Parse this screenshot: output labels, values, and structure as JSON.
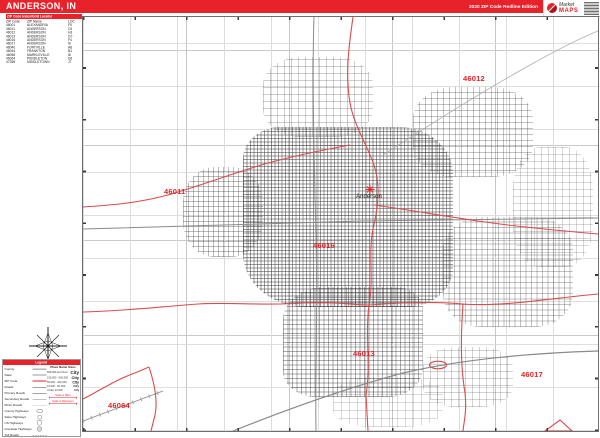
{
  "colors": {
    "accent_red": "#e8222a",
    "boundary_red": "#d94c4c"
  },
  "title_bar": {
    "title": "ANDERSON, IN",
    "edition": "2020 ZIP Code Redline Edition"
  },
  "logo": {
    "name_top": "Market",
    "name_bottom": "MAPS"
  },
  "zip_table": {
    "header": "ZIP Code Index/Grid Locator",
    "columns": [
      "ZIP Code",
      "ZIP Name",
      "LOC"
    ],
    "rows": [
      {
        "zip": "46001",
        "name": "ALEXANDRIA",
        "loc": "F5"
      },
      {
        "zip": "46011",
        "name": "ANDERSON",
        "loc": "C5"
      },
      {
        "zip": "46012",
        "name": "ANDERSON",
        "loc": "H3"
      },
      {
        "zip": "46013",
        "name": "ANDERSON",
        "loc": "G7"
      },
      {
        "zip": "46016",
        "name": "ANDERSON",
        "loc": "F4"
      },
      {
        "zip": "46017",
        "name": "ANDERSON",
        "loc": "I6"
      },
      {
        "zip": "46040",
        "name": "FORTVILLE",
        "loc": "A8"
      },
      {
        "zip": "46044",
        "name": "FRANKTON",
        "loc": "B1"
      },
      {
        "zip": "46056",
        "name": "MARKLEVILLE",
        "loc": "I8"
      },
      {
        "zip": "46064",
        "name": "PENDLETON",
        "loc": "D6"
      },
      {
        "zip": "47356",
        "name": "MIDDLETOWN",
        "loc": "J7"
      }
    ]
  },
  "map": {
    "city_label": "Anderson",
    "zip_labels": [
      {
        "code": "46012",
        "x": 380,
        "y": 57
      },
      {
        "code": "46011",
        "x": 81,
        "y": 170
      },
      {
        "code": "46016",
        "x": 230,
        "y": 224
      },
      {
        "code": "46013",
        "x": 270,
        "y": 332
      },
      {
        "code": "46017",
        "x": 438,
        "y": 353
      },
      {
        "code": "46064",
        "x": 25,
        "y": 384
      }
    ]
  },
  "legend": {
    "header": "Legend",
    "items": [
      {
        "label": "County",
        "sample": "line-thick"
      },
      {
        "label": "State",
        "sample": "line-med"
      },
      {
        "label": "ZIP Code",
        "sample": "line-red"
      },
      {
        "label": "Roads",
        "sample": "line-dark"
      },
      {
        "label": "Primary Roads",
        "sample": "line-dark"
      },
      {
        "label": "Secondary Roads",
        "sample": "line-gray"
      },
      {
        "label": "Minor Roads",
        "sample": "line-light"
      },
      {
        "label": "County Highways",
        "sample": "badge-oval"
      },
      {
        "label": "State Highways",
        "sample": "badge-circle"
      },
      {
        "label": "US Highways",
        "sample": "badge-shield"
      },
      {
        "label": "Interstate Highways",
        "sample": "badge-interstate"
      },
      {
        "label": "Toll Roads",
        "sample": "line-toll"
      }
    ],
    "place_names": {
      "header": "Place Name Sizes",
      "tiers": [
        {
          "range": "500,000 and Over",
          "sample": "City",
          "size": 9
        },
        {
          "range": "100,000 - 500,000",
          "sample": "City",
          "size": 8
        },
        {
          "range": "50,000 - 100,000",
          "sample": "City",
          "size": 7
        },
        {
          "range": "10,000 - 50,000",
          "sample": "City",
          "size": 6
        },
        {
          "range": "Under 10,000",
          "sample": "City",
          "size": 5
        }
      ]
    },
    "scale_bars": [
      {
        "label": "Scale in Miles"
      },
      {
        "label": "Scale in Kilometers"
      }
    ]
  }
}
